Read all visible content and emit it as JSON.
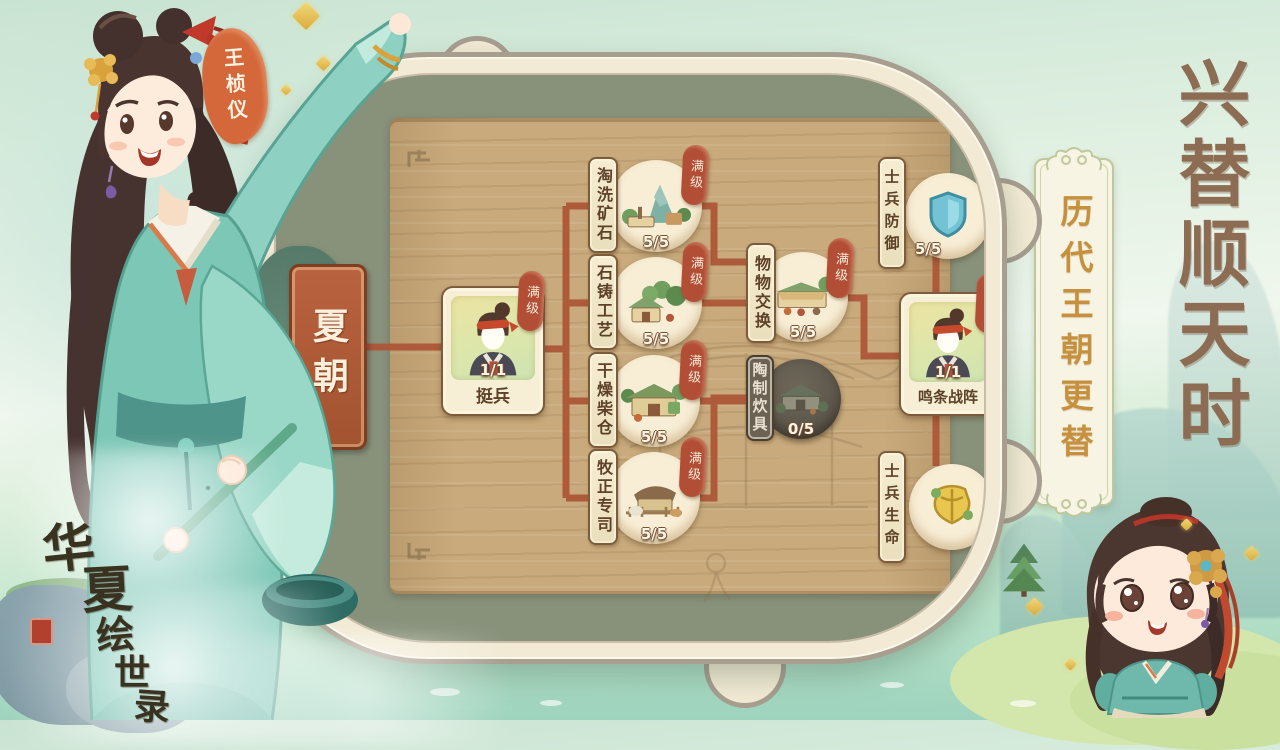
{
  "character": {
    "name_tag": "王桢仪"
  },
  "panel": {
    "dynasty": "夏朝"
  },
  "right_panel": {
    "headline": "兴替顺天时",
    "scroll_text": "历代王朝更替"
  },
  "logo": {
    "chars": [
      "华",
      "夏",
      "绘",
      "世",
      "录"
    ]
  },
  "labels": {
    "max_level": "满级"
  },
  "nodes": {
    "root": {
      "name": "挺兵",
      "level": "1/1"
    },
    "mine": {
      "name": "淘洗矿石",
      "level": "5/5"
    },
    "stone": {
      "name": "石铸工艺",
      "level": "5/5"
    },
    "wood": {
      "name": "干燥柴仓",
      "level": "5/5"
    },
    "herd": {
      "name": "牧正专司",
      "level": "5/5"
    },
    "barter": {
      "name": "物物交换",
      "level": "5/5"
    },
    "pottery": {
      "name": "陶制炊具",
      "level": "0/5"
    },
    "battle": {
      "name": "鸣条战阵",
      "level": "1/1"
    },
    "soldier_def": {
      "name": "士兵防御",
      "level": "5/5"
    },
    "soldier_hp": {
      "name": "士兵生命"
    }
  },
  "icons": {
    "root_portrait": "militia-portrait-icon",
    "mine": "ore-washing-building-icon",
    "stone": "stone-workshop-building-icon",
    "wood": "firewood-barn-building-icon",
    "herd": "herding-office-building-icon",
    "barter": "barter-market-building-icon",
    "pottery": "pottery-kitchen-building-icon",
    "soldier_def": "shield-icon",
    "soldier_hp": "armor-icon"
  },
  "colors": {
    "accent_red": "#b14e35",
    "connector": "#ad5638",
    "board_tan": "#c8aa7c",
    "panel_sage": "#88927b",
    "rim_cream": "#f2ead4",
    "gold_text": "#c6913e",
    "title_brown": "#8d6c54",
    "dynasty_red": "#b05a38",
    "tag_orange": "#d4683a",
    "locked_grey": "#6b6254"
  }
}
